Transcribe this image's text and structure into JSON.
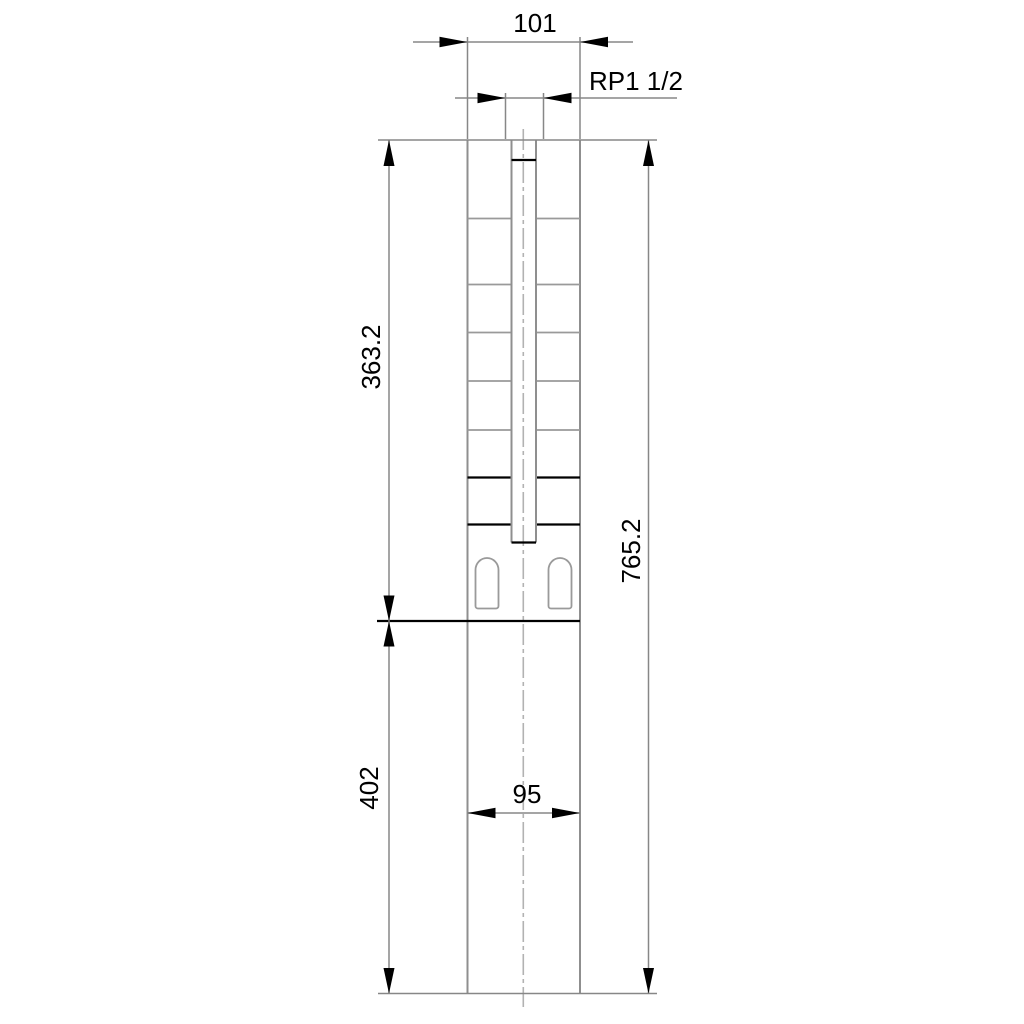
{
  "drawing": {
    "kind": "technical-dimensional-drawing",
    "dimensions": {
      "top_width": "101",
      "connection_thread": "RP1 1/2",
      "upper_section_height": "363.2",
      "total_height": "765.2",
      "lower_section_height": "402",
      "lower_width": "95"
    },
    "colors": {
      "background": "#ffffff",
      "object_line": "#8f8f8f",
      "dimension_line": "#878787",
      "centerline": "#b2b2b2",
      "emphasis_line": "#000000",
      "text": "#000000"
    }
  }
}
